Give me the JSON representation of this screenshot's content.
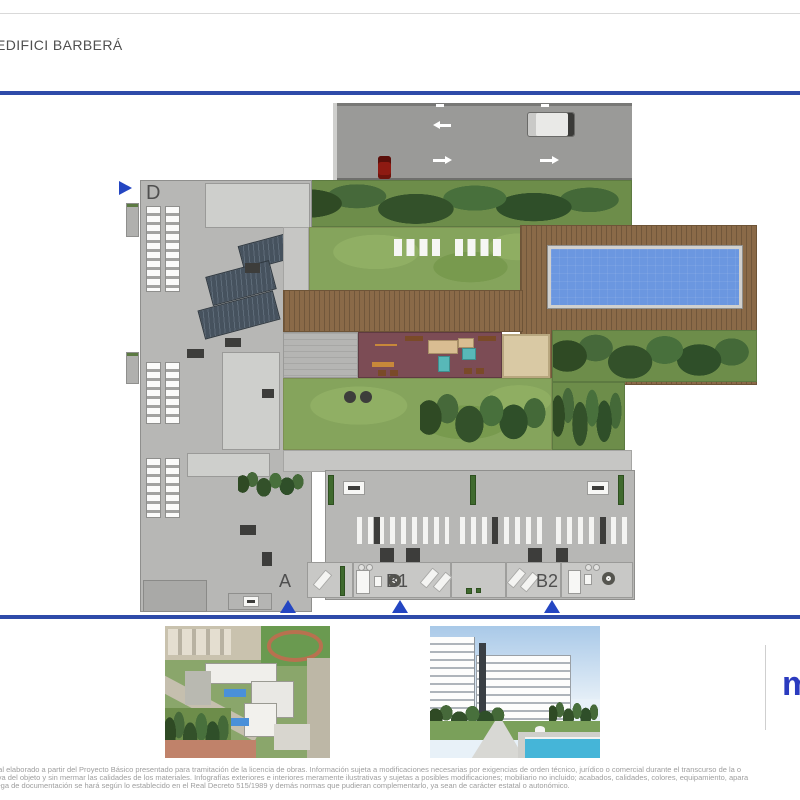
{
  "header": {
    "title": "EDIFICI BARBERÁ"
  },
  "colors": {
    "accent_blue": "#2e4ba9",
    "triangle_blue": "#2446c2",
    "logo_blue": "#2b3bbf",
    "pool_blue": "#6b97e0",
    "lawn_green": "#85a45c",
    "deck_brown": "#8a6a48",
    "playground_maroon": "#7c4c55"
  },
  "site_plan": {
    "block_labels": [
      {
        "id": "d",
        "label": "D"
      },
      {
        "id": "a",
        "label": "A"
      },
      {
        "id": "b1",
        "label": "B1"
      },
      {
        "id": "b2",
        "label": "B2"
      }
    ]
  },
  "logo": {
    "mark": "m"
  },
  "footer": {
    "lines": [
      "ual elaborado a partir del Proyecto Básico presentado para tramitación de la licencia de obras. Información sujeta a modificaciones necesarias por exigencias de orden técnico, jurídico o comercial durante el transcurso de la o",
      "tiva del objeto y sin mermar las calidades de los materiales. Infografías exteriores e interiores meramente ilustrativas y sujetas a posibles modificaciones; mobiliario no incluido; acabados, calidades, colores, equipamiento, apara",
      "rega de documentación se hará según lo establecido en el Real Decreto 515/1989 y demás normas que pudieran complementarlo, ya sean de carácter estatal o autonómico."
    ]
  }
}
